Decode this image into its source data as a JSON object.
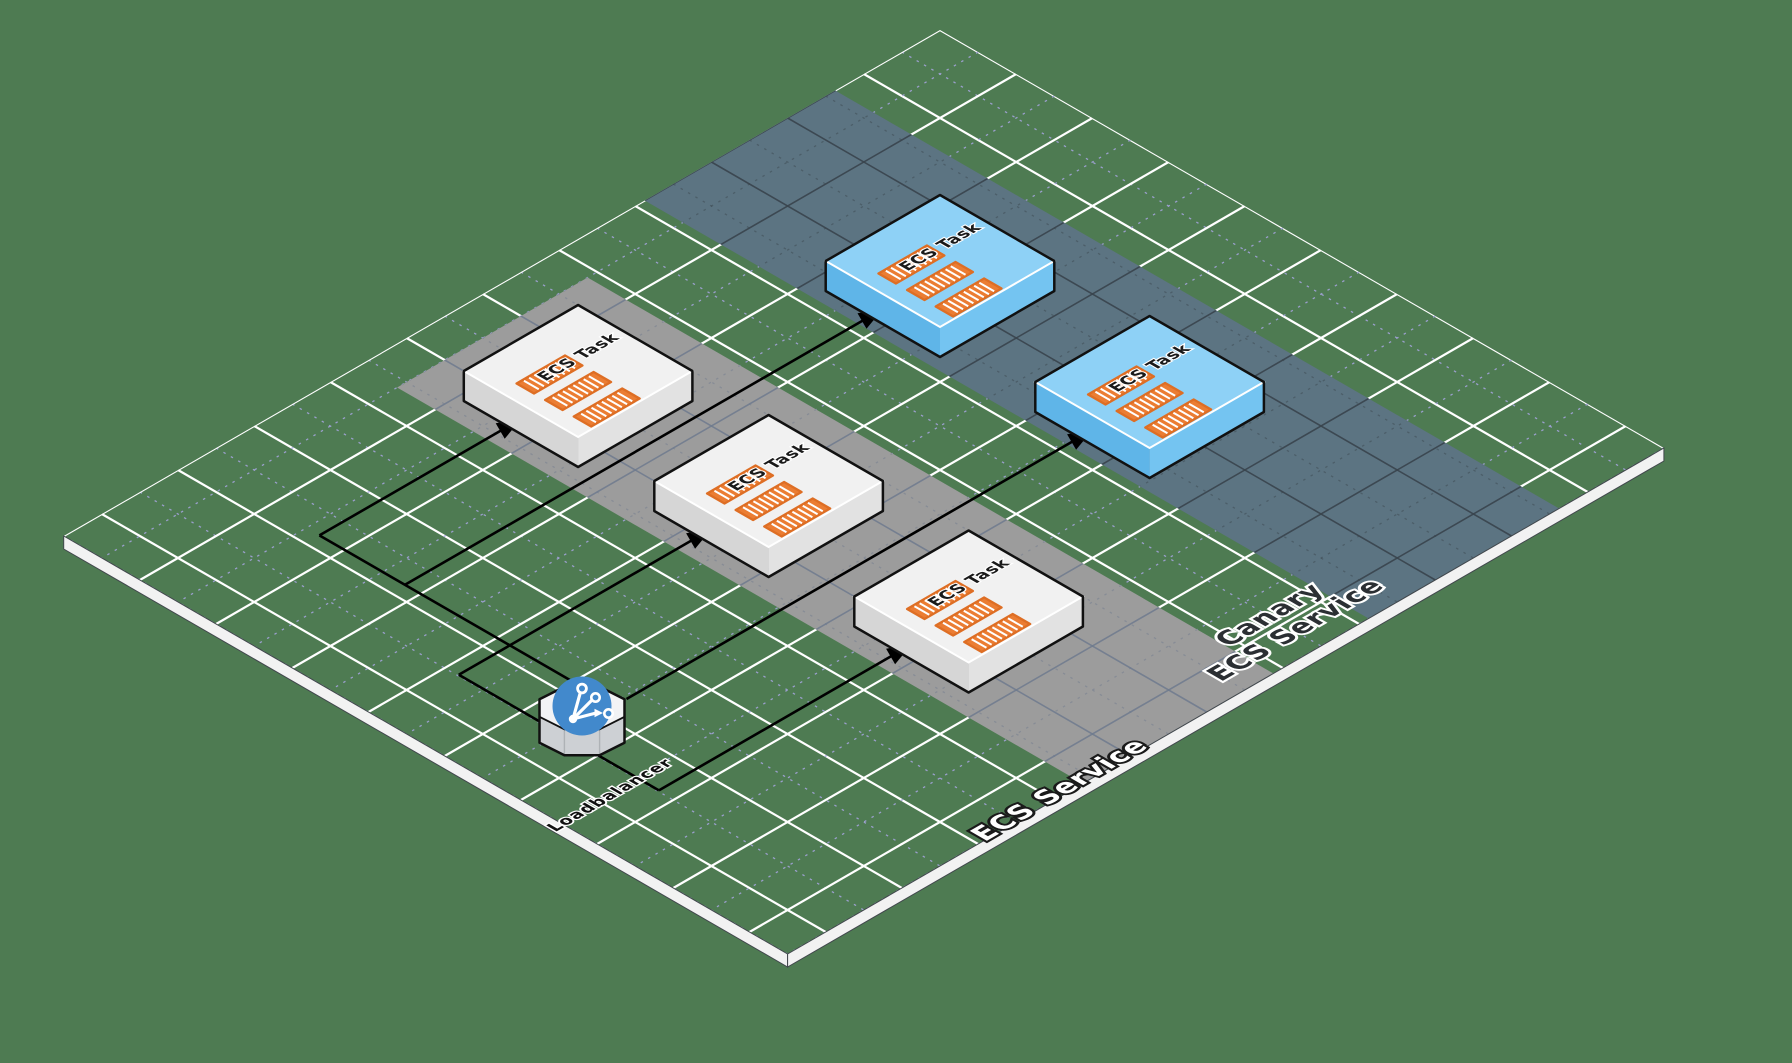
{
  "diagram": {
    "labels": {
      "loadbalancer": "Loadbalancer",
      "service_band": "ECS Service",
      "canary_band_line1": "Canary",
      "canary_band_line2": "ECS Service"
    },
    "tasks": [
      {
        "label": "ECS Task",
        "service": "standard"
      },
      {
        "label": "ECS Task",
        "service": "standard"
      },
      {
        "label": "ECS Task",
        "service": "standard"
      },
      {
        "label": "ECS Task",
        "service": "canary"
      },
      {
        "label": "ECS Task",
        "service": "canary"
      }
    ],
    "icons": {
      "loadbalancer": "share-branch-icon",
      "task": "container-stripes-icon"
    },
    "colors": {
      "background": "#4E7B52",
      "grid_major": "#FFFFFF",
      "grid_minor": "#A3A3D9",
      "band_standard": "#9C9C9C",
      "band_canary": "#5C7482",
      "task_top": "#F1F1F1",
      "task_side": "#D6D6D6",
      "canary_top": "#8ED1F6",
      "canary_side": "#5FB5E8",
      "container": "#EB7D33",
      "loadbalancer_badge": "#4289CC",
      "arrow": "#000000",
      "platform_edge": "#F2F2F2"
    }
  }
}
